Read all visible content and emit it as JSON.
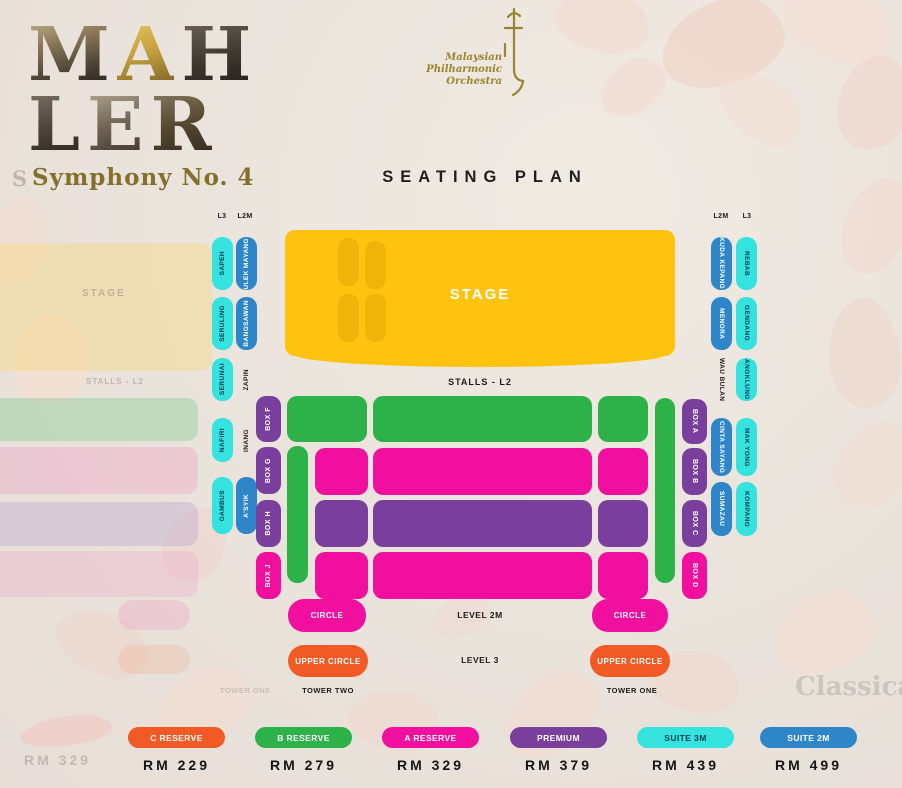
{
  "header": {
    "letters_row1": [
      "M",
      "A",
      "H"
    ],
    "letters_row2": [
      "L",
      "E",
      "R"
    ],
    "subtitle": "Symphony No. 4",
    "logo_lines": [
      "Malaysian",
      "Philharmonic",
      "Orchestra"
    ],
    "title": "SEATING PLAN"
  },
  "plan": {
    "stage_label": "STAGE",
    "stalls_label": "STALLS - L2",
    "left_headers": {
      "l3": "L3",
      "l2m": "L2M"
    },
    "right_headers": {
      "l2m": "L2M",
      "l3": "L3"
    },
    "left_l3": [
      "SAPEH",
      "SERULING",
      "SERUNAI",
      "NAFIRI",
      "GAMBUS"
    ],
    "left_l2m": [
      "ULEK MAYANG",
      "BANGSAWAN",
      "ZAPIN",
      "INANG",
      "A'SYIK"
    ],
    "left_boxes": [
      "BOX F",
      "BOX G",
      "BOX H",
      "BOX J"
    ],
    "right_boxes": [
      "BOX A",
      "BOX B",
      "BOX C",
      "BOX D"
    ],
    "right_l2m": [
      "KUDA KEPANG",
      "MENORA",
      "WAU BULAN",
      "CINTA SAYANG",
      "SUMAZAU"
    ],
    "right_l3": [
      "REBAB",
      "GENDANG",
      "ANGKLUNG",
      "MAK YONG",
      "KOMPANG"
    ],
    "level_2m": {
      "left_pill": "CIRCLE",
      "center": "LEVEL 2M",
      "right_pill": "CIRCLE"
    },
    "level_3": {
      "left_pill": "UPPER CIRCLE",
      "center": "LEVEL 3",
      "right_pill": "UPPER CIRCLE"
    },
    "towers": {
      "left": "TOWER TWO",
      "right": "TOWER ONE"
    }
  },
  "legend": {
    "items": [
      {
        "label": "C RESERVE",
        "price": "RM 229",
        "color": "#f15a24"
      },
      {
        "label": "B RESERVE",
        "price": "RM 279",
        "color": "#2db24a"
      },
      {
        "label": "A RESERVE",
        "price": "RM 329",
        "color": "#f00f9e"
      },
      {
        "label": "PREMIUM",
        "price": "RM 379",
        "color": "#7a3f9d"
      },
      {
        "label": "SUITE 3M",
        "price": "RM 439",
        "color": "#35e3de"
      },
      {
        "label": "SUITE 2M",
        "price": "RM 499",
        "color": "#2e86c9"
      }
    ]
  },
  "colors": {
    "stage_yellow": "#ffc20e",
    "green": "#2db24a",
    "pink": "#f00f9e",
    "purple": "#7a3f9d",
    "cyan": "#35e3de",
    "blue": "#2e86c9",
    "orange": "#f15a24"
  },
  "ghost": {
    "letter": "S",
    "stage": "STAGE",
    "stalls": "STALLS - L2",
    "tower": "TOWER ONE",
    "price": "RM 329",
    "classics": "Classical"
  }
}
